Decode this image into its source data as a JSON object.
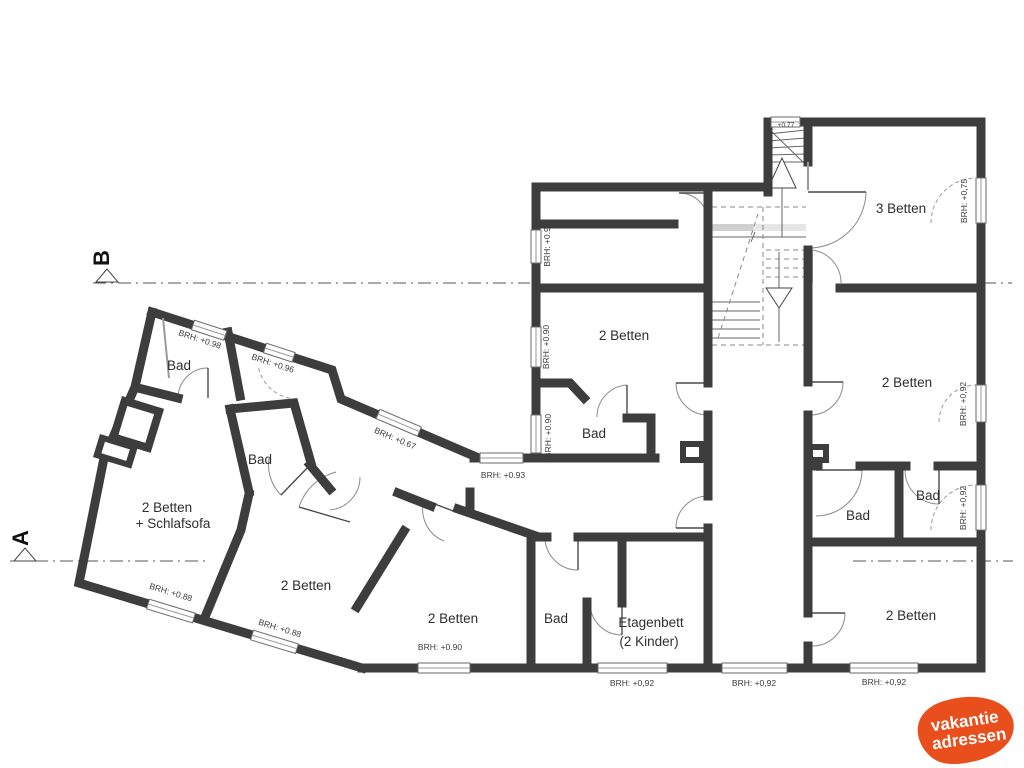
{
  "title": "Grundriss Ferienhaus (floor plan)",
  "colors": {
    "wall": "#3d3d3d",
    "logo_orange": "#e94f1c",
    "text": "#2e2e2e"
  },
  "sections": {
    "a": "A",
    "b": "B"
  },
  "logo": {
    "line1": "vakantie",
    "line2": "adressen"
  },
  "rooms": [
    {
      "label": "3 Betten",
      "x": 901,
      "y": 213
    },
    {
      "label": "2 Betten",
      "x": 624,
      "y": 340
    },
    {
      "label": "2 Betten",
      "x": 907,
      "y": 387
    },
    {
      "label": "Bad",
      "x": 594,
      "y": 438
    },
    {
      "label": "Bad",
      "x": 858,
      "y": 520
    },
    {
      "label": "Bad",
      "x": 928,
      "y": 500
    },
    {
      "label": "2 Betten",
      "x": 911,
      "y": 620
    },
    {
      "label": "Etagenbett",
      "x": 651,
      "y": 627
    },
    {
      "label": "(2 Kinder)",
      "x": 649,
      "y": 646
    },
    {
      "label": "Bad",
      "x": 556,
      "y": 623
    },
    {
      "label": "2 Betten",
      "x": 453,
      "y": 623
    },
    {
      "label": "2 Betten",
      "x": 306,
      "y": 590
    },
    {
      "label": "2 Betten",
      "x": 167,
      "y": 512
    },
    {
      "label": "+ Schlafsofa",
      "x": 173,
      "y": 528
    },
    {
      "label": "Bad",
      "x": 179,
      "y": 370
    },
    {
      "label": "Bad",
      "x": 260,
      "y": 464
    }
  ],
  "brh": [
    {
      "t": "BRH: +0.9",
      "x": 550,
      "y": 247,
      "r": -90
    },
    {
      "t": "BRH: +0.90",
      "x": 549,
      "y": 347,
      "r": -90
    },
    {
      "t": "BRH: +0.90",
      "x": 551,
      "y": 436,
      "r": -90
    },
    {
      "t": "BRH: +0.93",
      "x": 503,
      "y": 478,
      "r": 0
    },
    {
      "t": "BRH: +0.67",
      "x": 394,
      "y": 441,
      "r": 23
    },
    {
      "t": "BRH: +0.98",
      "x": 199,
      "y": 342,
      "r": 18
    },
    {
      "t": "BRH: +0.96",
      "x": 272,
      "y": 366,
      "r": 18
    },
    {
      "t": "BRH: +0.88",
      "x": 170,
      "y": 595,
      "r": 17
    },
    {
      "t": "BRH: +0.88",
      "x": 279,
      "y": 631,
      "r": 17
    },
    {
      "t": "BRH: +0.90",
      "x": 440,
      "y": 650,
      "r": 0
    },
    {
      "t": "BRH: +0,92",
      "x": 632,
      "y": 686,
      "r": 0
    },
    {
      "t": "BRH: +0,92",
      "x": 754,
      "y": 686,
      "r": 0
    },
    {
      "t": "BRH: +0,92",
      "x": 884,
      "y": 685,
      "r": 0
    },
    {
      "t": "BRH: +0,75",
      "x": 967,
      "y": 201,
      "r": -90
    },
    {
      "t": "BRH: +0,92",
      "x": 966,
      "y": 404,
      "r": -90
    },
    {
      "t": "BRH: +0,92",
      "x": 966,
      "y": 508,
      "r": -90
    },
    {
      "t": "+0.77",
      "x": 786,
      "y": 127,
      "r": 0,
      "s": true
    }
  ]
}
